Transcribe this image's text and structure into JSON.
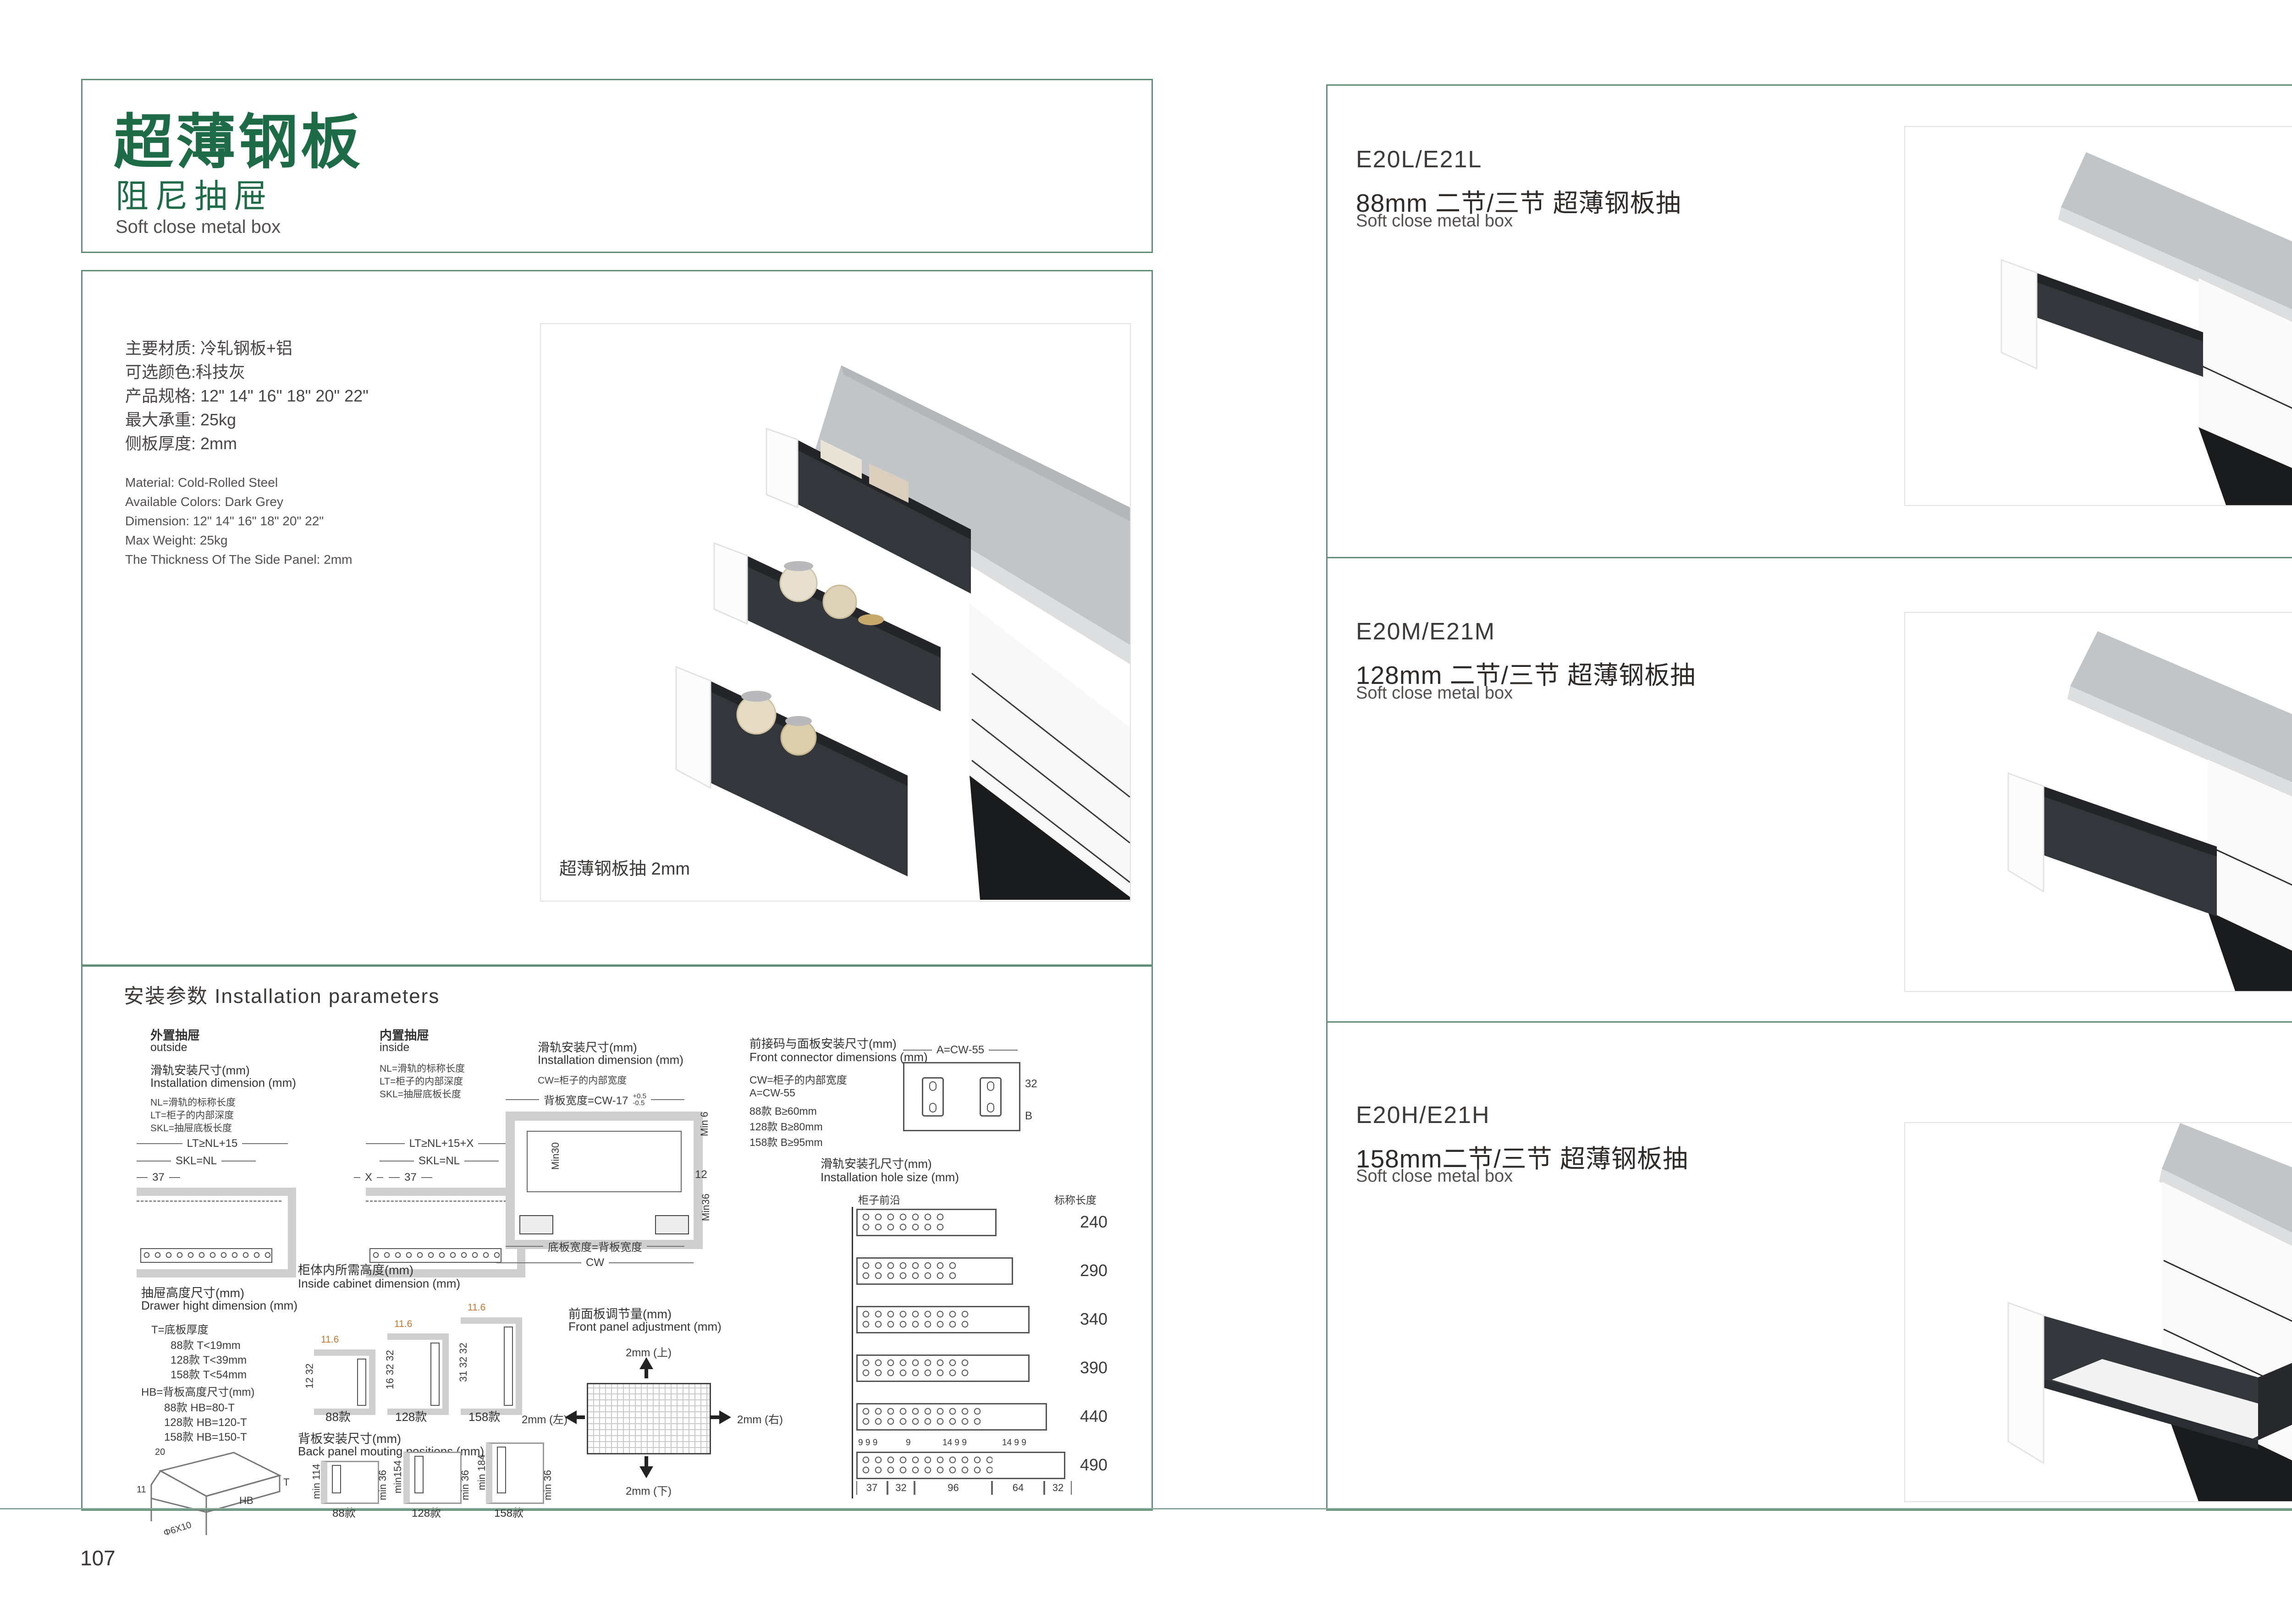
{
  "colors": {
    "green": "#1e6b47",
    "border_green": "#618e77",
    "text_dark": "#403b39",
    "orange": "#c8762b",
    "drawer_dark": "#33363b",
    "panel_gray": "#cfcfcf"
  },
  "left": {
    "title_cn": "超薄钢板",
    "subtitle_cn": "阻尼抽屉",
    "subtitle_en": "Soft close metal box",
    "specs_cn": [
      "主要材质: 冷轧钢板+铝",
      "可选颜色:科技灰",
      "产品规格: 12\" 14\" 16\" 18\" 20\" 22\"",
      "最大承重: 25kg",
      "侧板厚度: 2mm"
    ],
    "specs_en": [
      "Material: Cold-Rolled Steel",
      "Available Colors: Dark Grey",
      "Dimension: 12\" 14\" 16\" 18\" 20\" 22\"",
      "Max Weight: 25kg",
      "The Thickness Of The Side Panel: 2mm"
    ],
    "photo_caption": "超薄钢板抽 2mm",
    "page_number": "107"
  },
  "install": {
    "title": "安装参数 Installation parameters",
    "outside": {
      "label_cn": "外置抽屉",
      "label_en": "outside",
      "dim_cn": "滑轨安装尺寸(mm)",
      "dim_en": "Installation dimension (mm)",
      "note1": "NL=滑轨的标称长度",
      "note2": "LT=柜子的内部深度",
      "note3": "SKL=抽屉底板长度",
      "d1": "LT≥NL+15",
      "d2": "SKL=NL",
      "d3": "37"
    },
    "inside": {
      "label_cn": "内置抽屉",
      "label_en": "inside",
      "note1": "NL=滑轨的标称长度",
      "note2": "LT=柜子的内部深度",
      "note3": "SKL=抽屉底板长度",
      "d1": "LT≥NL+15+X",
      "d2": "SKL=NL",
      "d3": "37",
      "d4": "X"
    },
    "width": {
      "title_cn": "滑轨安装尺寸(mm)",
      "title_en": "Installation dimension (mm)",
      "note": "CW=柜子的内部宽度",
      "top_dim": "背板宽度=CW-17",
      "tol_up": "+0.5",
      "tol_dn": "-0.5",
      "min6": "Min 6",
      "d12": "12",
      "min30": "Min30",
      "min36": "Min36",
      "bottom_dim": "底板宽度=背板宽度",
      "cw": "CW"
    },
    "connector": {
      "title_cn": "前接码与面板安装尺寸(mm)",
      "title_en": "Front connector  dimensions (mm)",
      "note1": "CW=柜子的内部宽度",
      "note2": "A=CW-55",
      "note3": "88款   B≥60mm",
      "note4": "128款  B≥80mm",
      "note5": "158款  B≥95mm",
      "top_dim": "A=CW-55",
      "d32": "32",
      "db": "B"
    },
    "holes": {
      "title_cn": "滑轨安装孔尺寸(mm)",
      "title_en": "Installation hole size (mm)",
      "front_edge": "柜子前沿",
      "len_label": "标称长度",
      "len1": "240",
      "len2": "290",
      "len3": "340",
      "len4": "390",
      "len5": "440",
      "len6": "490",
      "sd1": "9 9 9",
      "sd2": "9",
      "sd3": "14 9 9",
      "sd4": "14 9 9",
      "bd1": "37",
      "bd2": "32",
      "bd3": "96",
      "bd4": "64",
      "bd5": "32"
    },
    "height": {
      "title_cn": "抽屉高度尺寸(mm)",
      "title_en": "Drawer hight dimension (mm)",
      "t_label": "T=底板厚度",
      "t1": "88款   T<19mm",
      "t2": "128款  T<39mm",
      "t3": "158款  T<54mm",
      "hb_label": "HB=背板高度尺寸(mm)",
      "hb1": "88款   HB=80-T",
      "hb2": "128款  HB=120-T",
      "hb3": "158款  HB=150-T",
      "iso_d20": "20",
      "iso_d11": "11",
      "iso_screw": "Φ6X10",
      "iso_hb": "HB",
      "iso_t": "T"
    },
    "cabinet": {
      "title_cn": "柜体内所需高度(mm)",
      "title_en": "Inside cabinet dimension (mm)",
      "v1": {
        "label": "88款",
        "top": "11.6",
        "side": "12 32"
      },
      "v2": {
        "label": "128款",
        "top": "11.6",
        "side": "16 32 32"
      },
      "v3": {
        "label": "158款",
        "top": "11.6",
        "side": "31 32 32"
      }
    },
    "back": {
      "title_cn": "背板安装尺寸(mm)",
      "title_en": "Back panel mouting positions (mm)",
      "v1": {
        "label": "88款",
        "o1": "min 114",
        "o2": "108",
        "o3": "min 36"
      },
      "v2": {
        "label": "128款",
        "o1": "min154",
        "o2": "148",
        "o3": "min 36"
      },
      "v3": {
        "label": "158款",
        "o1": "min 184",
        "o2": "178",
        "o3": "min 36"
      }
    },
    "front": {
      "title_cn": "前面板调节量(mm)",
      "title_en": "Front panel adjustment (mm)",
      "up": "2mm (上)",
      "down": "2mm (下)",
      "left": "2mm (左)",
      "right": "2mm (右)"
    }
  },
  "right": {
    "s1": {
      "code": "E20L/E21L",
      "name_cn": "88mm 二节/三节 超薄钢板抽",
      "name_en": "Soft close metal box"
    },
    "s2": {
      "code": "E20M/E21M",
      "name_cn": "128mm 二节/三节 超薄钢板抽",
      "name_en": "Soft close metal box"
    },
    "s3": {
      "code": "E20H/E21H",
      "name_cn": "158mm二节/三节 超薄钢板抽",
      "name_en": "Soft close metal box"
    },
    "page_number": "108"
  }
}
